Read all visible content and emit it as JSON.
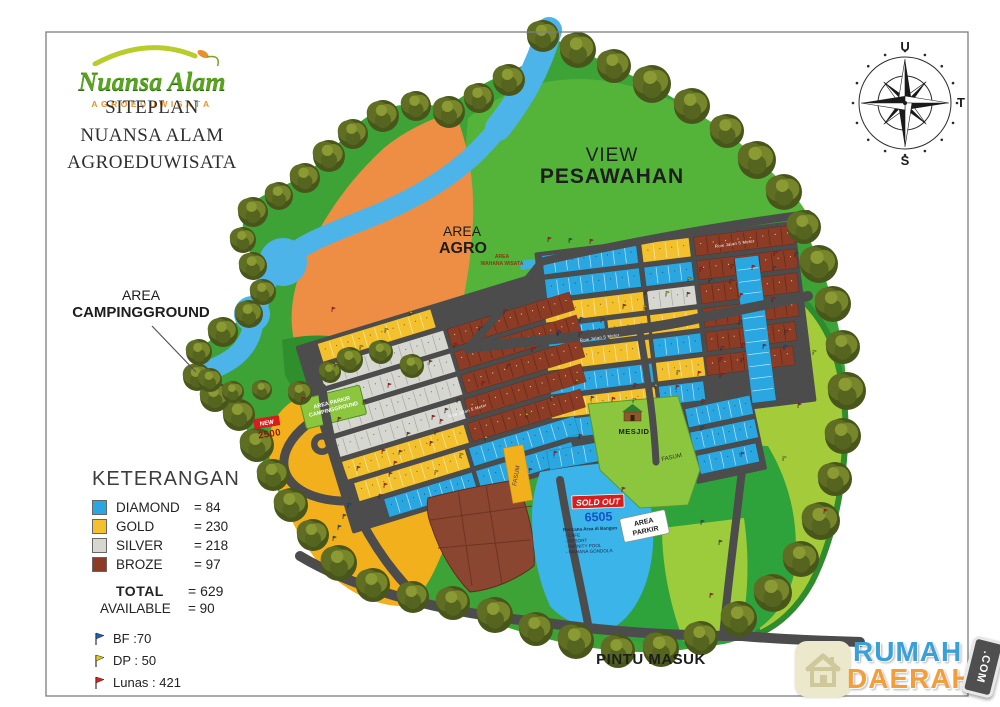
{
  "header": {
    "logo": {
      "name": "Nuansa Alam",
      "subtitle": "AGROEDUWISATA"
    },
    "title_lines": [
      "SITEPLAN",
      "NUANSA ALAM",
      "AGROEDUWISATA"
    ]
  },
  "compass": {
    "north": "U",
    "east": "T",
    "south": "S"
  },
  "map": {
    "labels": {
      "view_line1": "VIEW",
      "view_line2": "PESAWAHAN",
      "agro_line1": "AREA",
      "agro_line2": "AGRO",
      "camping_line1": "AREA",
      "camping_line2": "CAMPINGGROUND",
      "wahana_line1": "AREA",
      "wahana_line2": "WAHANA WISATA",
      "parkircamp_line1": "AREA PARKIR",
      "parkircamp_line2": "CAMPINGGROUND",
      "mesjid": "MESJID",
      "fasum_a": "FASUM",
      "fasum_b": "FASUM",
      "areaparkir_line1": "AREA",
      "areaparkir_line2": "PARKIR",
      "pintu_masuk": "PINTU MASUK",
      "road_a": "Row Jalan 5 Meter",
      "road_b": "Row Jalan 5 Meter",
      "road_c": "Row Jalan 5 Meter"
    },
    "signs": {
      "new_top": "NEW",
      "new_value": "2500",
      "sold_out": "SOLD OUT",
      "sold_out_value": "6505",
      "plan_title": "Rencana Area di Bangun",
      "plan_items": [
        "- CAFE",
        "- RESORT",
        "- INFINITY POOL",
        "- WAHANA GONDOLA"
      ]
    }
  },
  "legend": {
    "title": "KETERANGAN",
    "items": [
      {
        "label": "DIAMOND",
        "value": "= 84",
        "color": "#2aa7e1"
      },
      {
        "label": "GOLD",
        "value": "= 230",
        "color": "#f2c12d"
      },
      {
        "label": "SILVER",
        "value": "= 218",
        "color": "#d7d7d2"
      },
      {
        "label": "BROZE",
        "value": "= 97",
        "color": "#8c3b24"
      }
    ],
    "total_label": "TOTAL",
    "total_value": "= 629",
    "available_label": "AVAILABLE",
    "available_value": "= 90",
    "markers": [
      {
        "label": "BF :70",
        "color": "#1d5fb5"
      },
      {
        "label": "DP : 50",
        "color": "#ddca1a"
      },
      {
        "label": "Lunas : 421",
        "color": "#dd1f1a"
      }
    ]
  },
  "watermark": {
    "brand_line1": "RUMAH",
    "brand_line2": "DAERAH",
    "tag": ".COM"
  }
}
